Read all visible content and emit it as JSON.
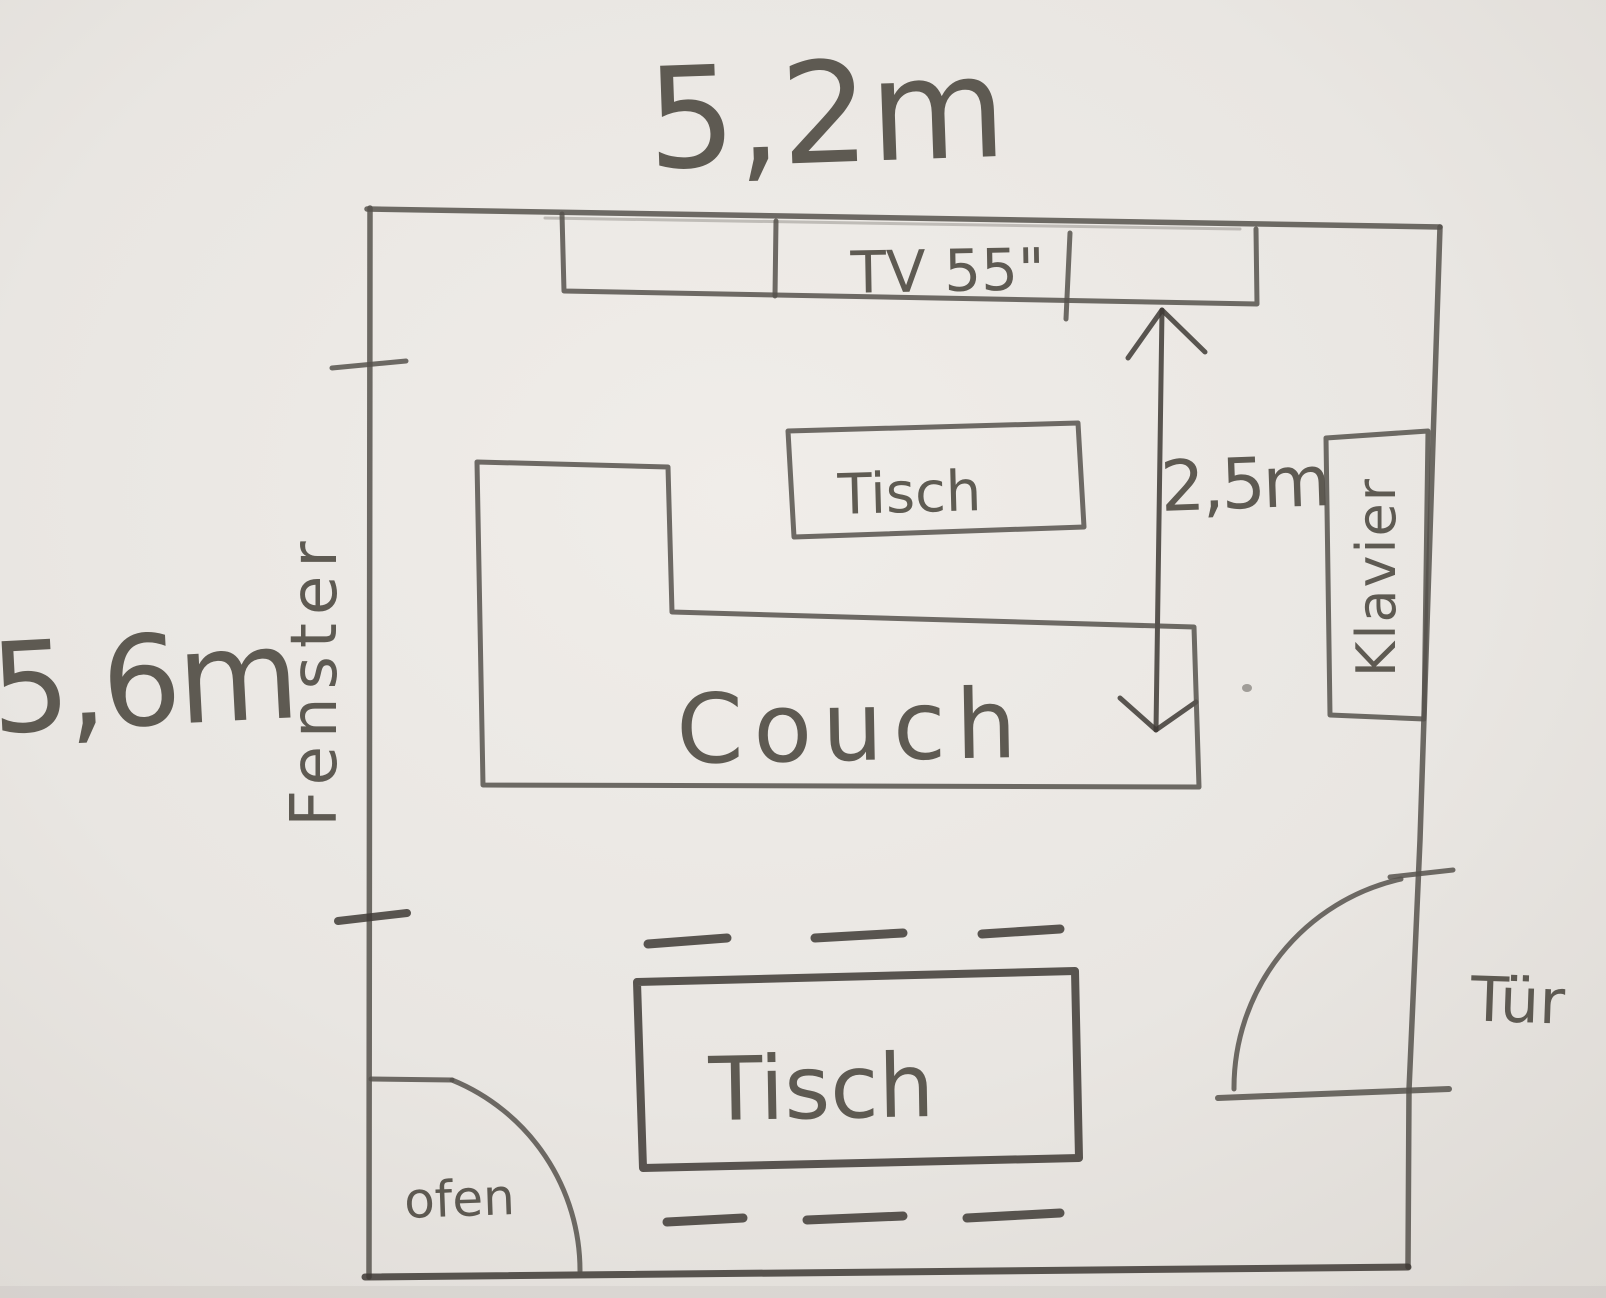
{
  "drawing": {
    "labels": {
      "room_width": "5,2m",
      "room_height": "5,6m",
      "tv": "TV 55\"",
      "distance_tv_couch": "2,5m",
      "table_upper": "Tisch",
      "couch": "Couch",
      "piano": "Klavier",
      "window": "Fenster",
      "table_lower": "Tisch",
      "oven": "ofen",
      "door": "Tür"
    },
    "colors": {
      "paper": "#e9e6e2",
      "pencil": "#56524c",
      "pencil_dark": "#3e3a35",
      "ink": "#464239"
    }
  }
}
